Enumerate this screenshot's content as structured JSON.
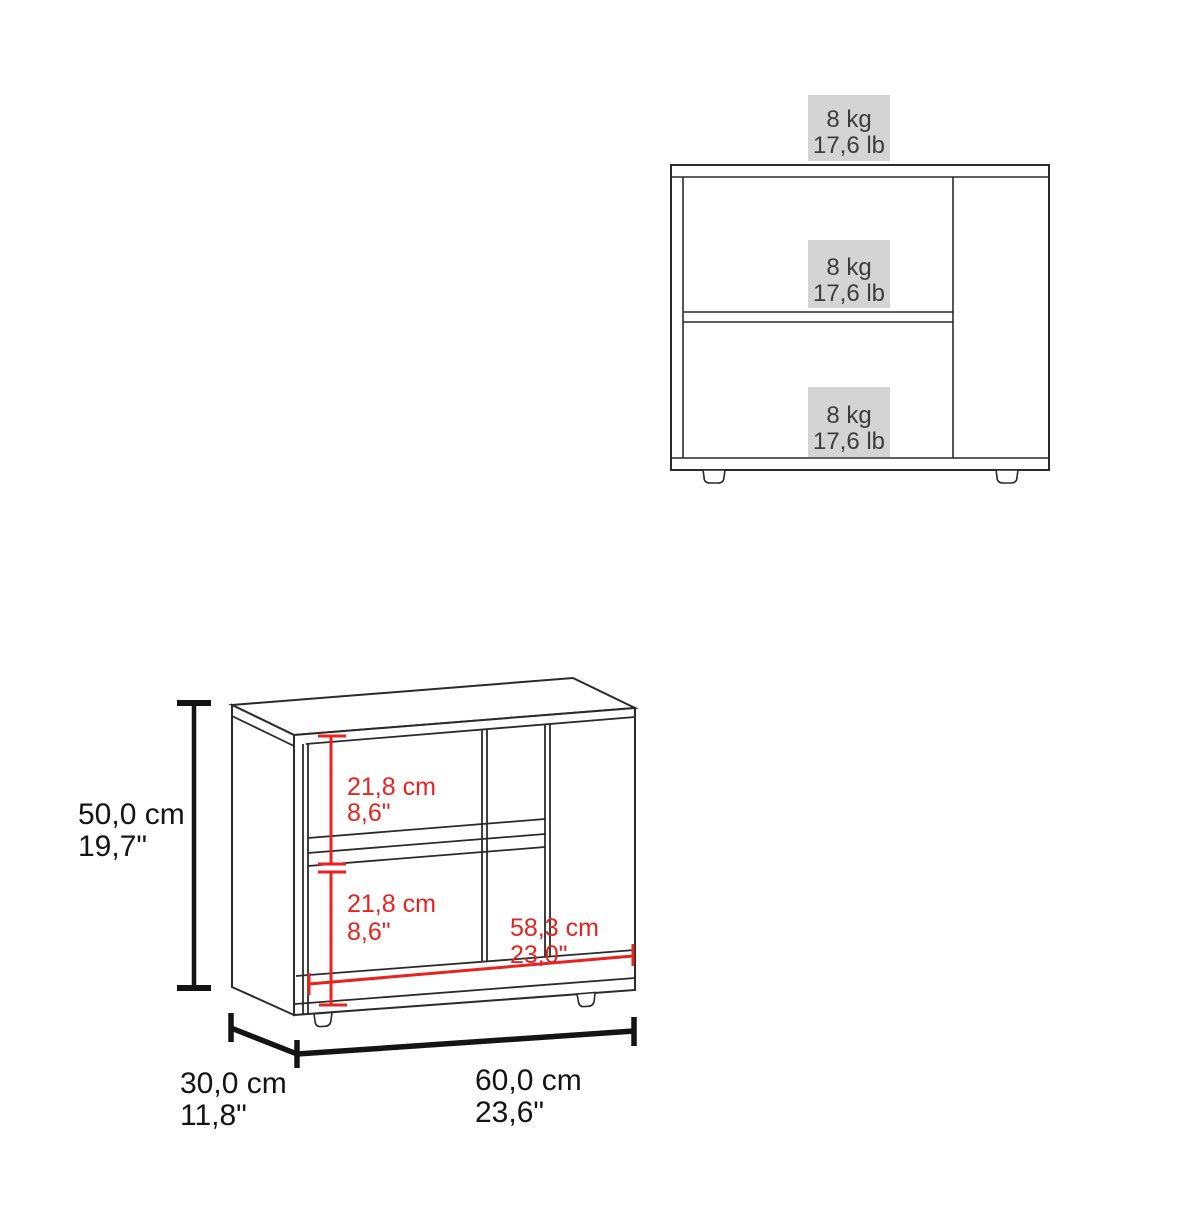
{
  "colors": {
    "cabinet_line": "#2b2b2b",
    "dimension_black": "#141414",
    "dimension_red": "#e8231f",
    "badge_bg": "#d4d4d4",
    "badge_text": "#3d3d3d"
  },
  "front_view": {
    "badges": [
      {
        "weight_kg": "8 kg",
        "weight_lb": "17,6 lb"
      },
      {
        "weight_kg": "8 kg",
        "weight_lb": "17,6 lb"
      },
      {
        "weight_kg": "8 kg",
        "weight_lb": "17,6 lb"
      }
    ]
  },
  "perspective_view": {
    "height": {
      "metric": "50,0 cm",
      "imperial": "19,7\""
    },
    "upper_shelf_height": {
      "metric": "21,8 cm",
      "imperial": "8,6\""
    },
    "lower_shelf_height": {
      "metric": "21,8 cm",
      "imperial": "8,6\""
    },
    "interior_width": {
      "metric": "58,3 cm",
      "imperial": "23,0\""
    },
    "depth": {
      "metric": "30,0 cm",
      "imperial": "11,8\""
    },
    "width": {
      "metric": "60,0 cm",
      "imperial": "23,6\""
    }
  }
}
